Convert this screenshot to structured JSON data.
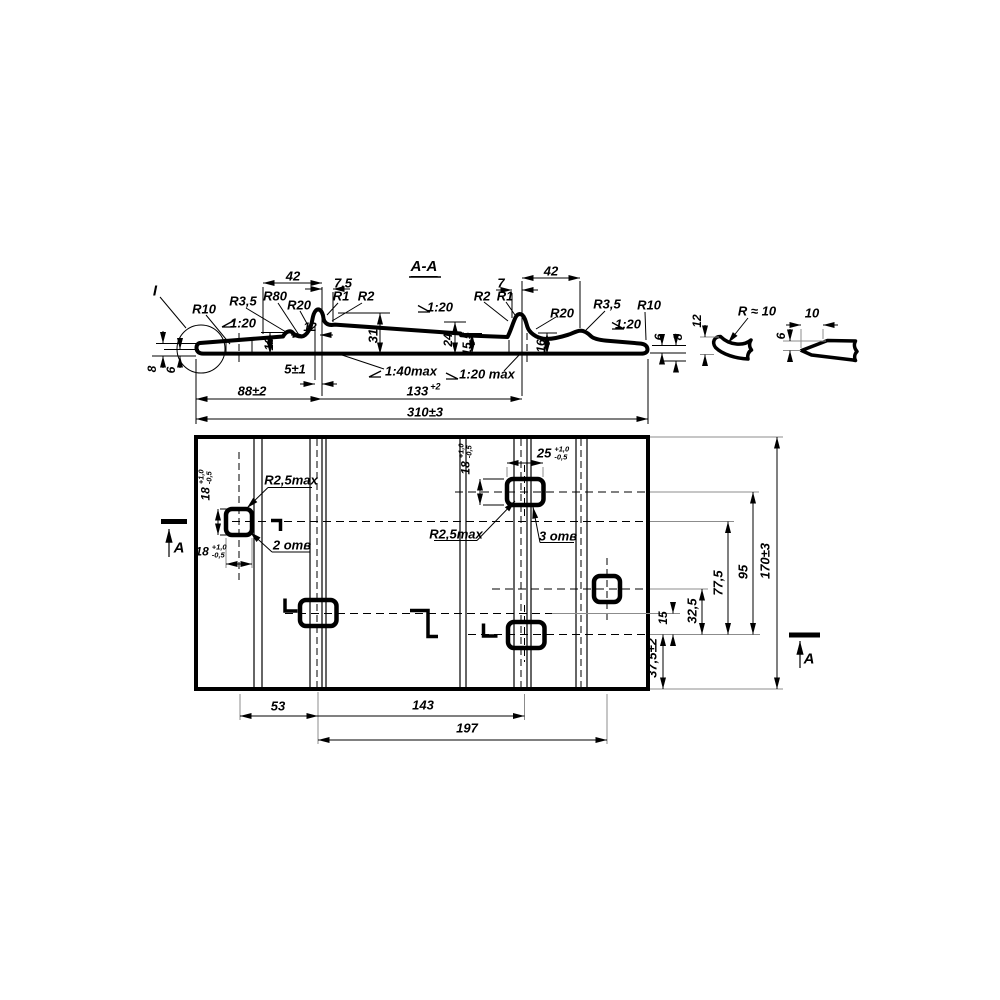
{
  "section": {
    "title": "A-A",
    "detail_mark": "I",
    "r10": "R10",
    "r3_5": "R3,5",
    "r80": "R80",
    "r20": "R20",
    "r1": "R1",
    "r2": "R2",
    "slope_1_20": "1:20",
    "slope_1_40_max": "1:40max",
    "slope_1_20_max": "1:20 max",
    "dim_42": "42",
    "dim_7_5": "7,5",
    "dim_7": "7",
    "dim_12": "12",
    "dim_16": "16",
    "dim_31": "31",
    "dim_24": "24",
    "dim_15_5": "15,5",
    "dim_8": "8",
    "dim_6": "6",
    "dim_5": "5±1",
    "dim_88": "88±2",
    "dim_133_base": "133",
    "dim_133_tol": "+2",
    "dim_310": "310±3"
  },
  "details": {
    "radius_approx": "R ≈ 10",
    "dim_12": "12",
    "dim_10": "10",
    "dim_6": "6"
  },
  "plan": {
    "section_letter": "A",
    "dim_18": "18",
    "dim_25": "25",
    "tol_plus": "+1,0",
    "tol_minus": "-0,5",
    "radius_max": "R2,5max",
    "holes_2": "2 отв",
    "holes_3": "3 отв",
    "dim_170": "170±3",
    "dim_95": "95",
    "dim_77_5": "77,5",
    "dim_32_5": "32,5",
    "dim_15": "15",
    "dim_37_5": "37,5±2",
    "dim_53": "53",
    "dim_143": "143",
    "dim_197": "197"
  }
}
